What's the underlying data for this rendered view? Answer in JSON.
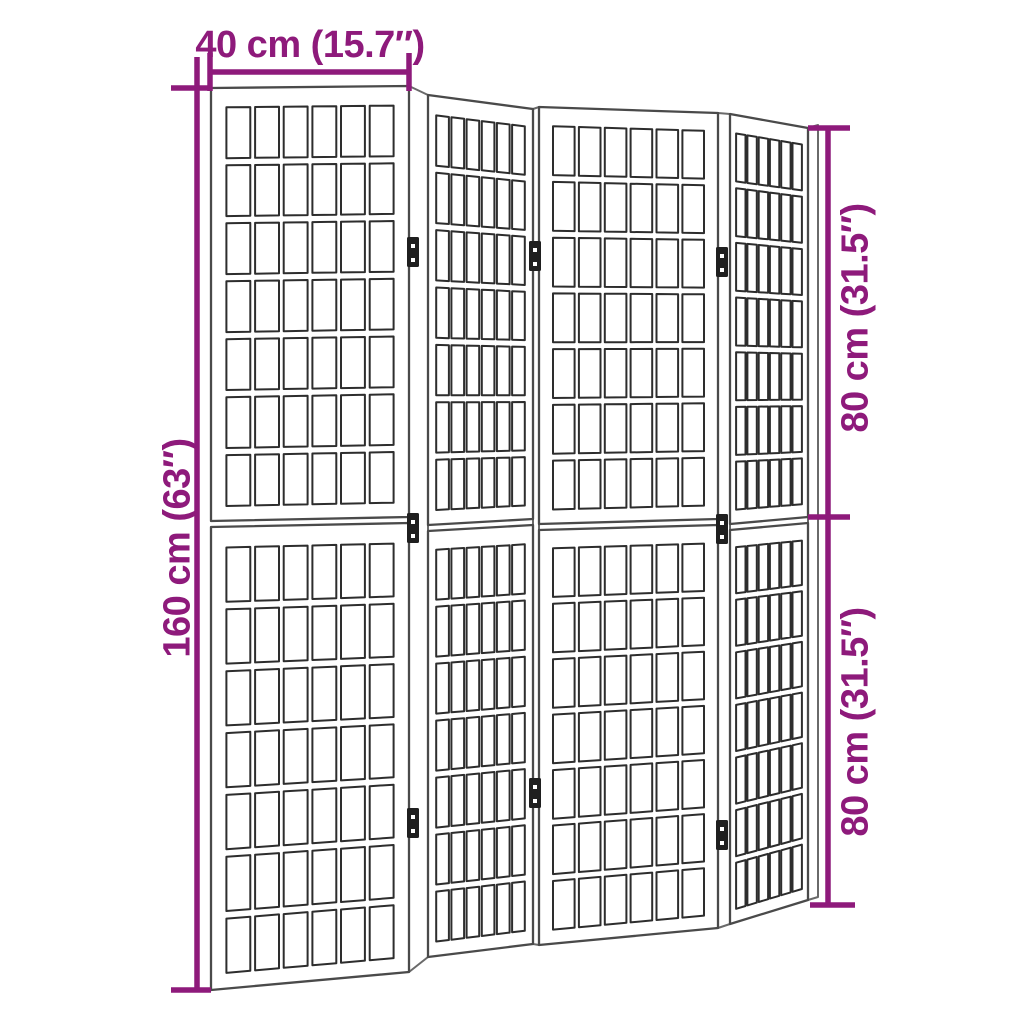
{
  "figure": {
    "title": "Folding room divider dimension diagram",
    "product": "4-panel shoji-style folding room divider",
    "colors": {
      "accent": "#8e1a7b",
      "frame_line": "#4a4a4a",
      "grid_line": "#2d2d2d",
      "contour_line": "#6a6a6a",
      "hinge": "#1f1f1f",
      "panel_fill": "#ffffff",
      "background": "#ffffff"
    },
    "dimensions": {
      "width_top": "40 cm (15.7″)",
      "height_left": "160 cm (63″)",
      "height_right_upper": "80 cm (31.5″)",
      "height_right_lower": "80 cm (31.5″)"
    },
    "structure": {
      "panel_count": 4,
      "halves_per_panel": 2,
      "grid_columns": 6,
      "grid_rows_per_half": 7,
      "hinge_count": 8
    }
  }
}
